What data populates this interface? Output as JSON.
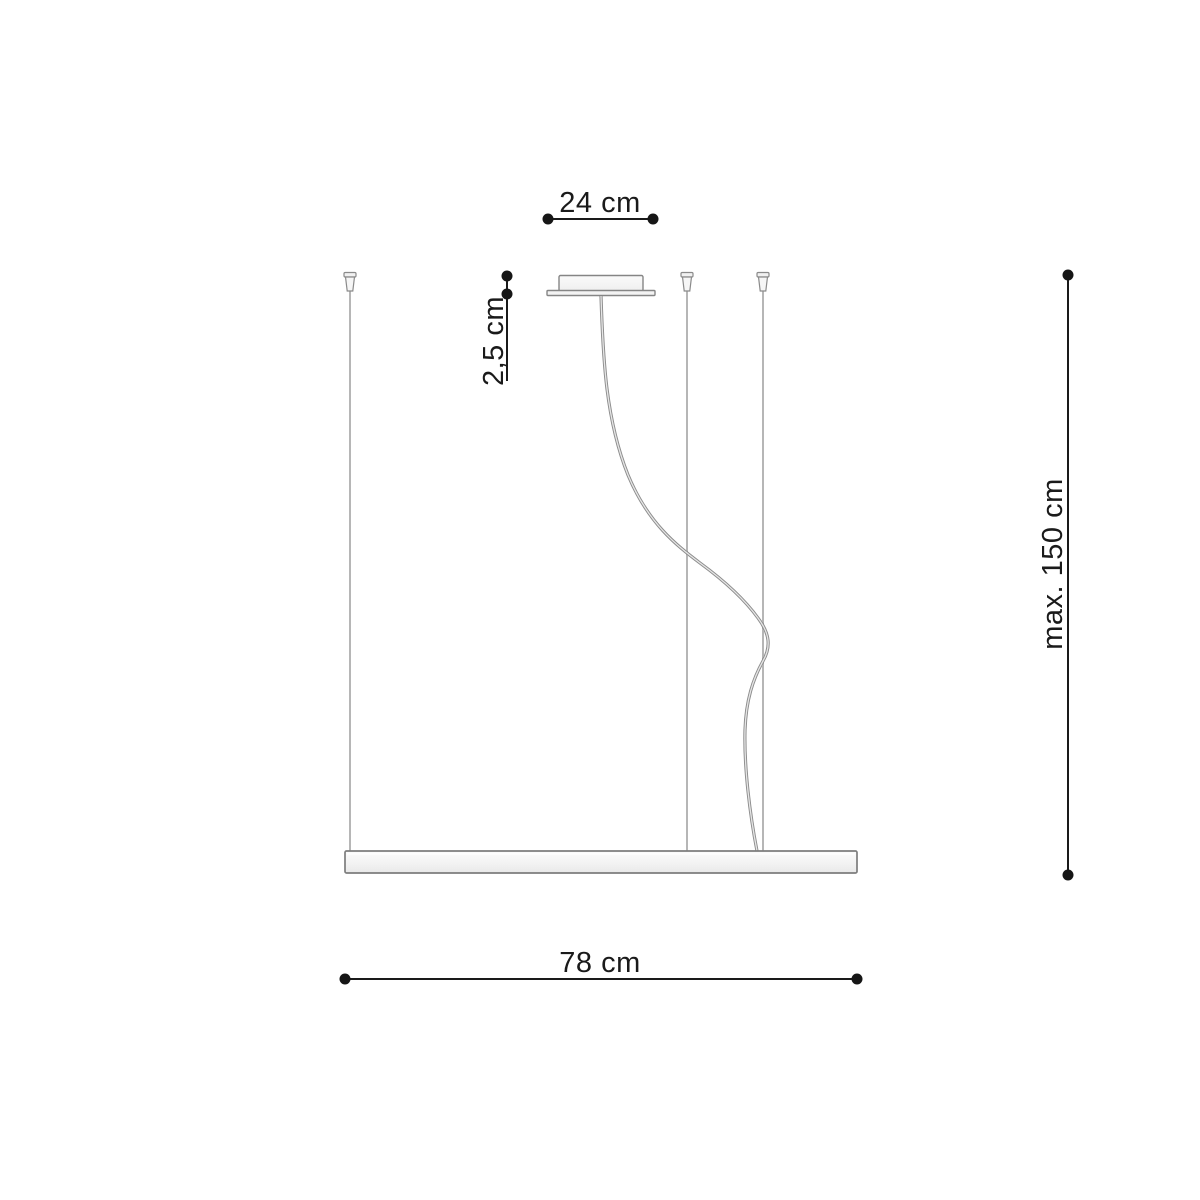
{
  "diagram": {
    "dimensions": {
      "canopy_width": {
        "label": "24 cm"
      },
      "canopy_height": {
        "label": "2,5 cm"
      },
      "max_drop": {
        "label": "max. 150 cm"
      },
      "lamp_width": {
        "label": "78 cm"
      }
    },
    "colors": {
      "dimension_line": "#1a1a1a",
      "fixture_stroke": "#858585",
      "fixture_fill": "#f4f4f4",
      "wire": "#9a9a9a",
      "cable_outer": "#8c8c8c",
      "cable_inner": "#e6e6e6",
      "background": "#ffffff"
    }
  }
}
